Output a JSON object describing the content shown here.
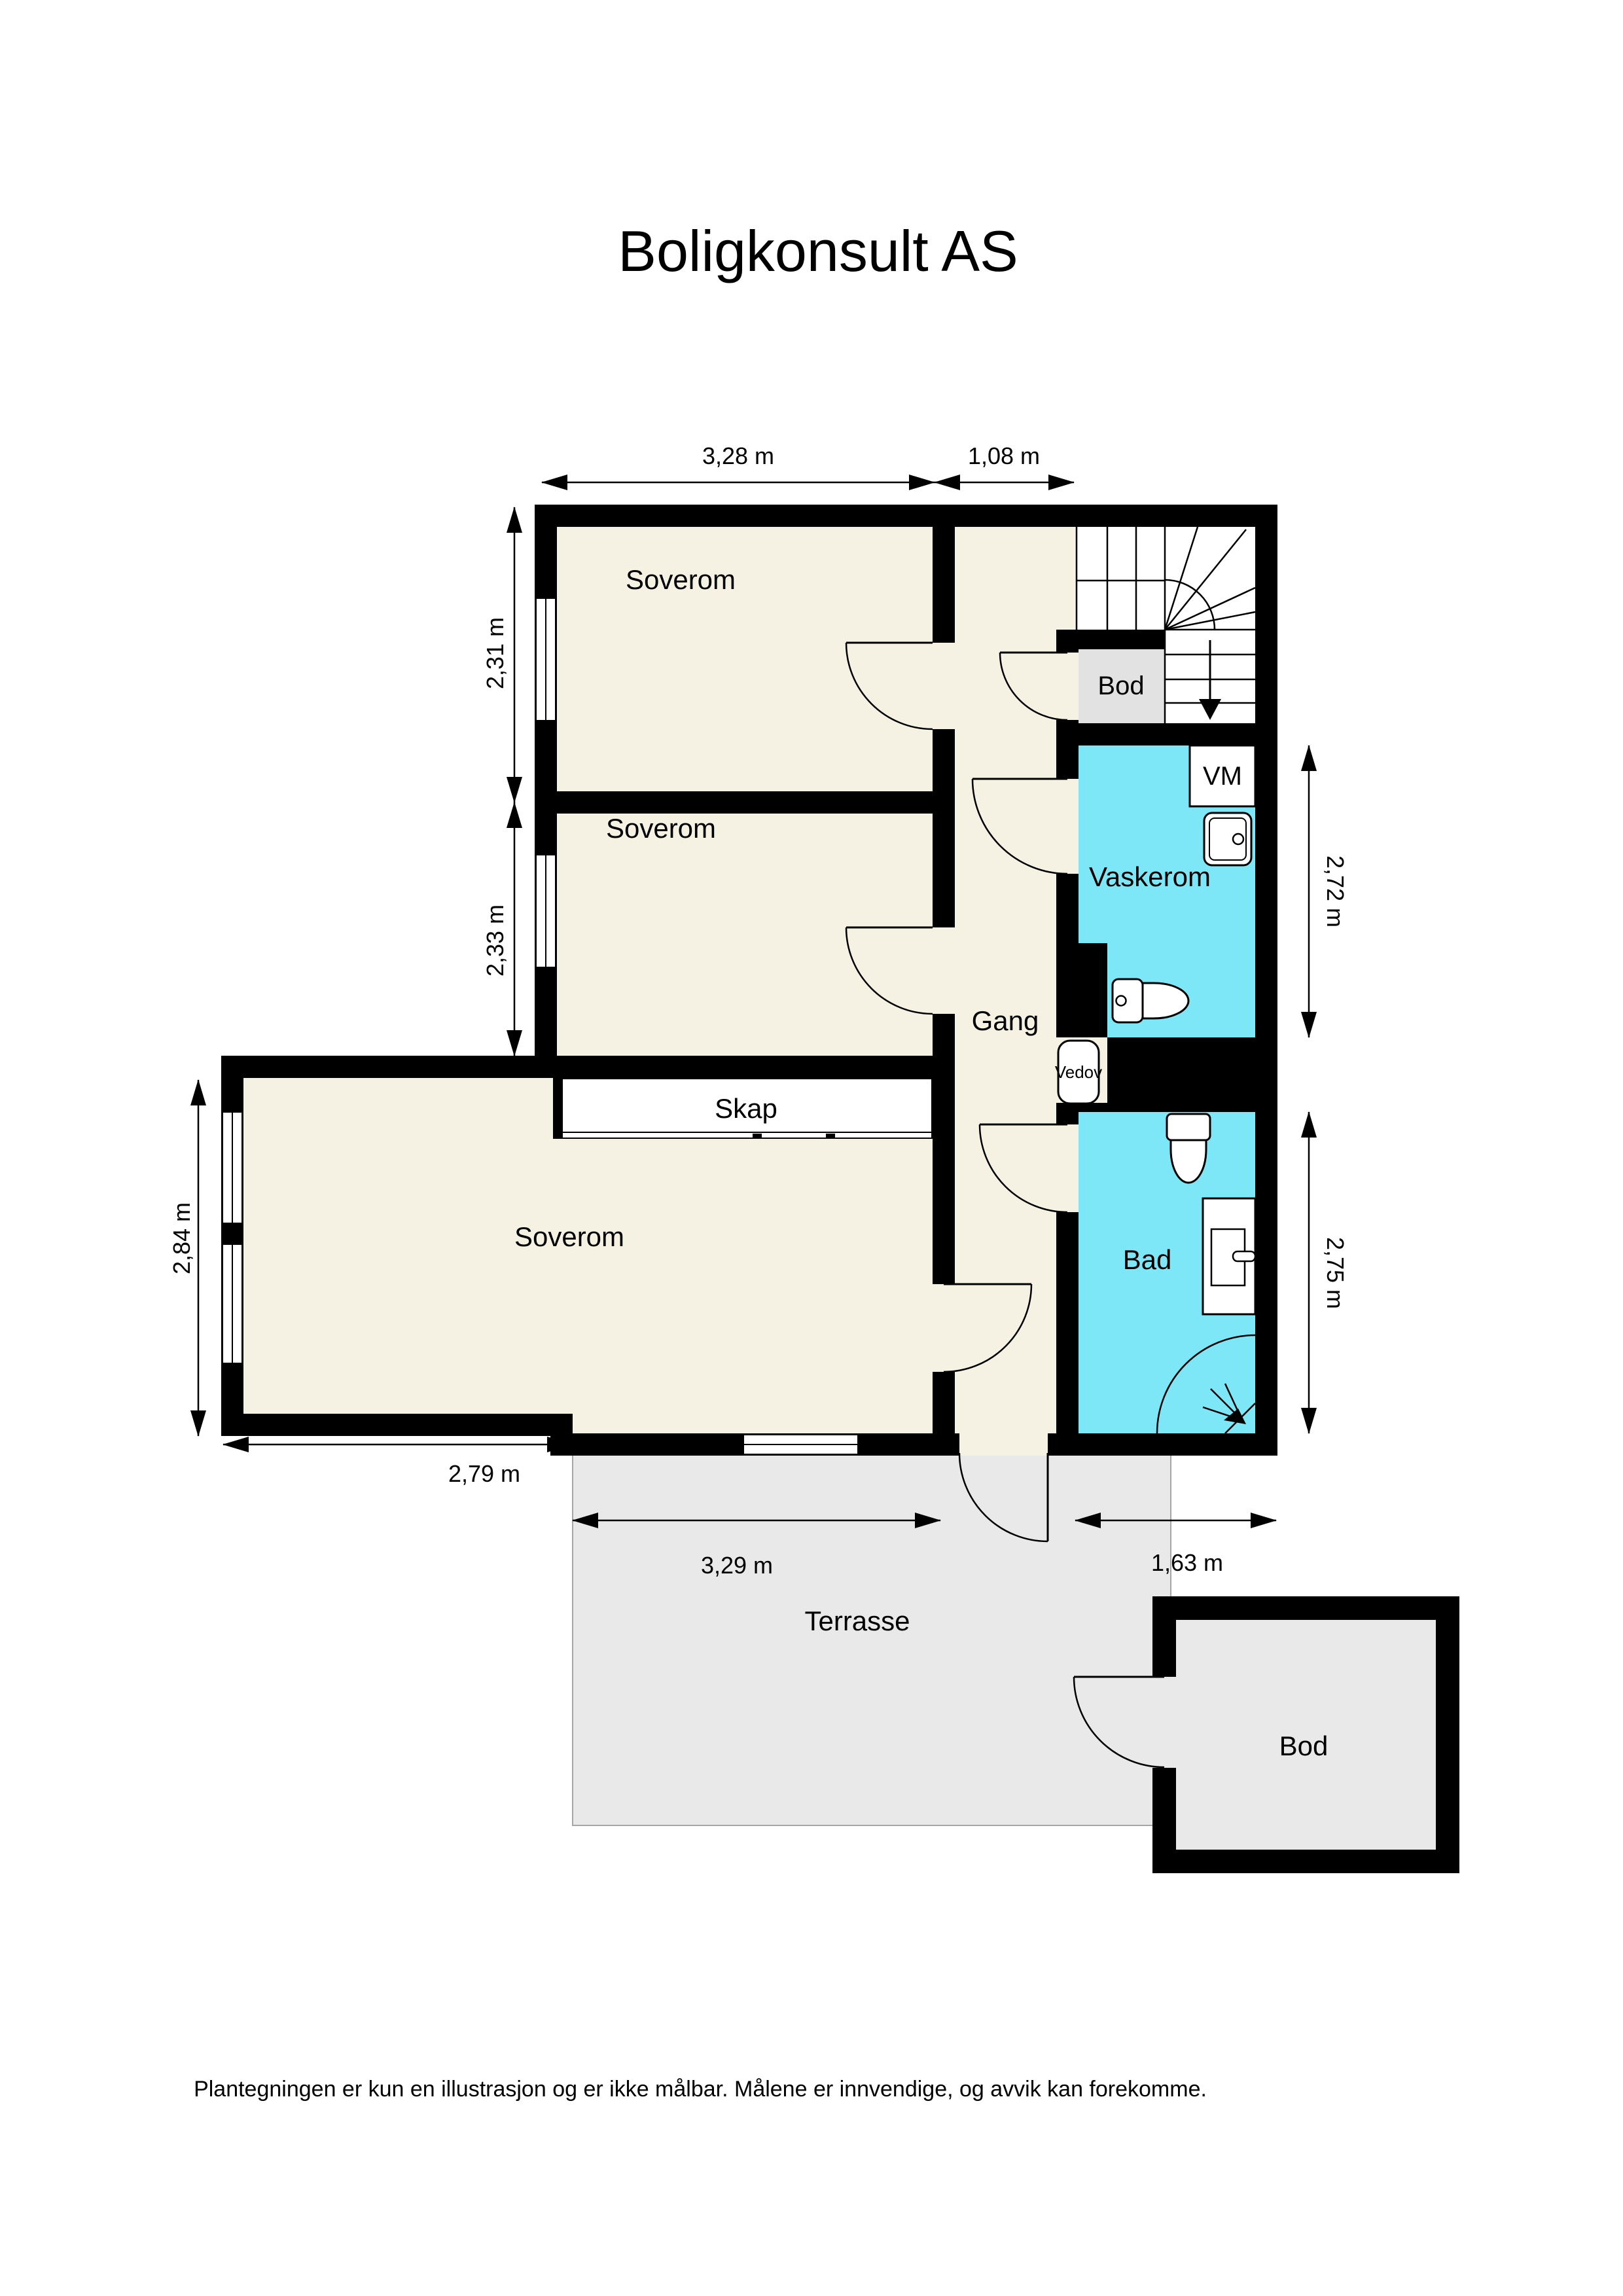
{
  "title": "Boligkonsult AS",
  "footer": {
    "disclaimer": "Plantegningen er kun en illustrasjon og er ikke målbar. Målene er innvendige, og avvik kan forekomme."
  },
  "rooms": {
    "soverom_top": "Soverom",
    "soverom_mid": "Soverom",
    "soverom_bottom": "Soverom",
    "gang": "Gang",
    "vaskerom": "Vaskerom",
    "bad": "Bad",
    "bod_inner": "Bod",
    "bod_outer": "Bod",
    "skap": "Skap",
    "terrasse": "Terrasse"
  },
  "fixtures": {
    "washing_machine": "VM",
    "wood_stove": "Vedov"
  },
  "dimensions": {
    "top_bedroom_width": "3,28 m",
    "hall_width": "1,08 m",
    "top_bedroom_height": "2,31 m",
    "mid_bedroom_height": "2,33 m",
    "bottom_bedroom_height": "2,84 m",
    "bottom_bedroom_width": "2,79 m",
    "terrace_side_width": "3,29 m",
    "bathroom_width": "1,63 m",
    "laundry_height": "2,72 m",
    "bathroom_height": "2,75 m"
  },
  "colors": {
    "wall": "#000000",
    "room_floor": "#F6F2E3",
    "wet_room": "#7DE6F7",
    "storage_inner": "#E2E2E2",
    "terrace": "#E9E9E9"
  }
}
